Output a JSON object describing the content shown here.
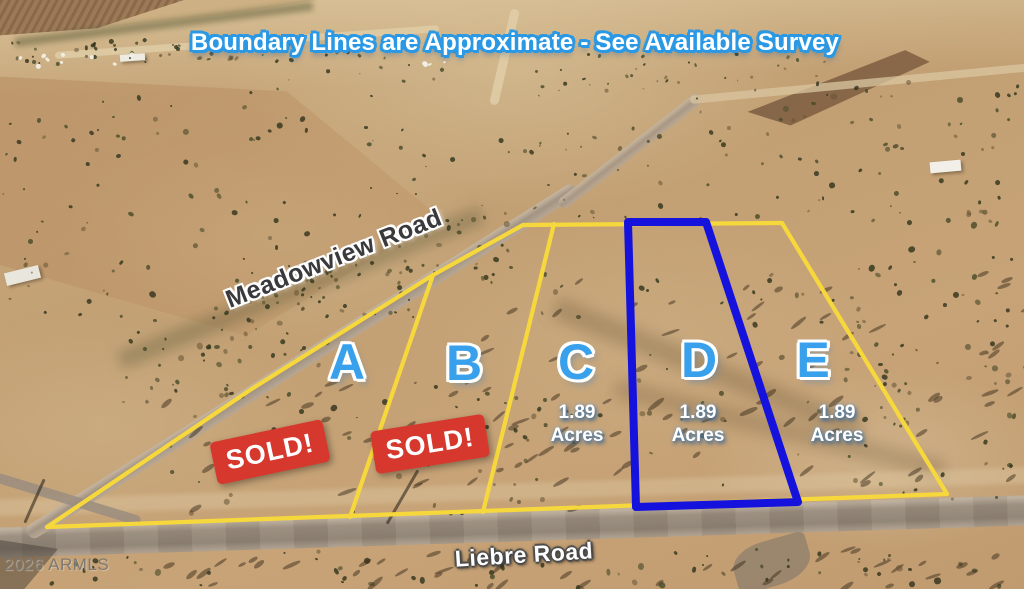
{
  "banner": {
    "text": "Boundary Lines are Approximate - See Available Survey"
  },
  "roads": {
    "top": {
      "name": "Meadowview Road"
    },
    "bottom": {
      "name": "Liebre Road"
    }
  },
  "watermark": {
    "text": "2026 ARMLS"
  },
  "lots": {
    "a": {
      "label": "A",
      "status": "SOLD!"
    },
    "b": {
      "label": "B",
      "status": "SOLD!"
    },
    "c": {
      "label": "C",
      "size": "1.89",
      "unit": "Acres"
    },
    "d": {
      "label": "D",
      "size": "1.89",
      "unit": "Acres"
    },
    "e": {
      "label": "E",
      "size": "1.89",
      "unit": "Acres"
    }
  },
  "colors": {
    "boundary_yellow": "#f7d83c",
    "boundary_blue": "#1512de",
    "lot_label_blue": "#39a1ec",
    "sold_red": "#d7382d",
    "banner_outline_blue": "#2b98e4"
  }
}
